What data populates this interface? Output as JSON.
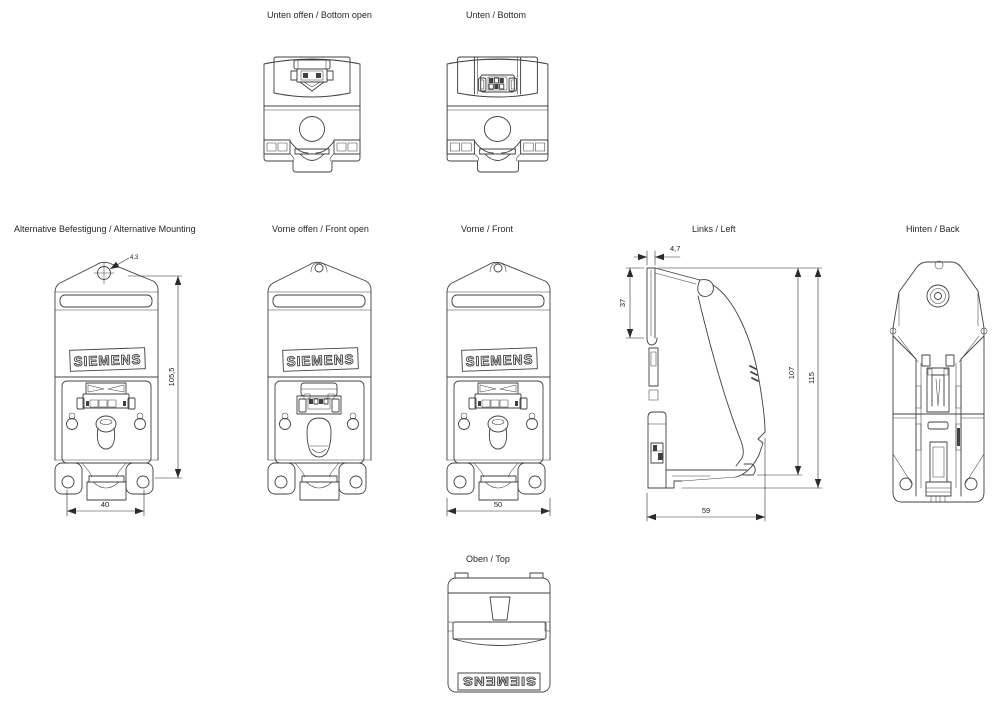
{
  "brand": {
    "logo": "SIEMENS"
  },
  "colors": {
    "line": "#404040",
    "text": "#262626",
    "background": "#ffffff"
  },
  "views": {
    "bottom_open": {
      "label": "Unten offen / Bottom open"
    },
    "bottom": {
      "label": "Unten / Bottom"
    },
    "alt_mounting": {
      "label": "Alternative Befestigung / Alternative Mounting",
      "dims": {
        "hole_diameter": "4,3",
        "height": "105,5",
        "hole_spacing": "40"
      }
    },
    "front_open": {
      "label": "Vorne offen / Front open"
    },
    "front": {
      "label": "Vorne / Front",
      "dims": {
        "width": "50"
      }
    },
    "left": {
      "label": "Links / Left",
      "dims": {
        "clip_depth": "4,7",
        "upper_height": "37",
        "body_height": "107",
        "total_height": "115",
        "depth": "59"
      }
    },
    "back": {
      "label": "Hinten / Back"
    },
    "top": {
      "label": "Oben / Top"
    }
  }
}
